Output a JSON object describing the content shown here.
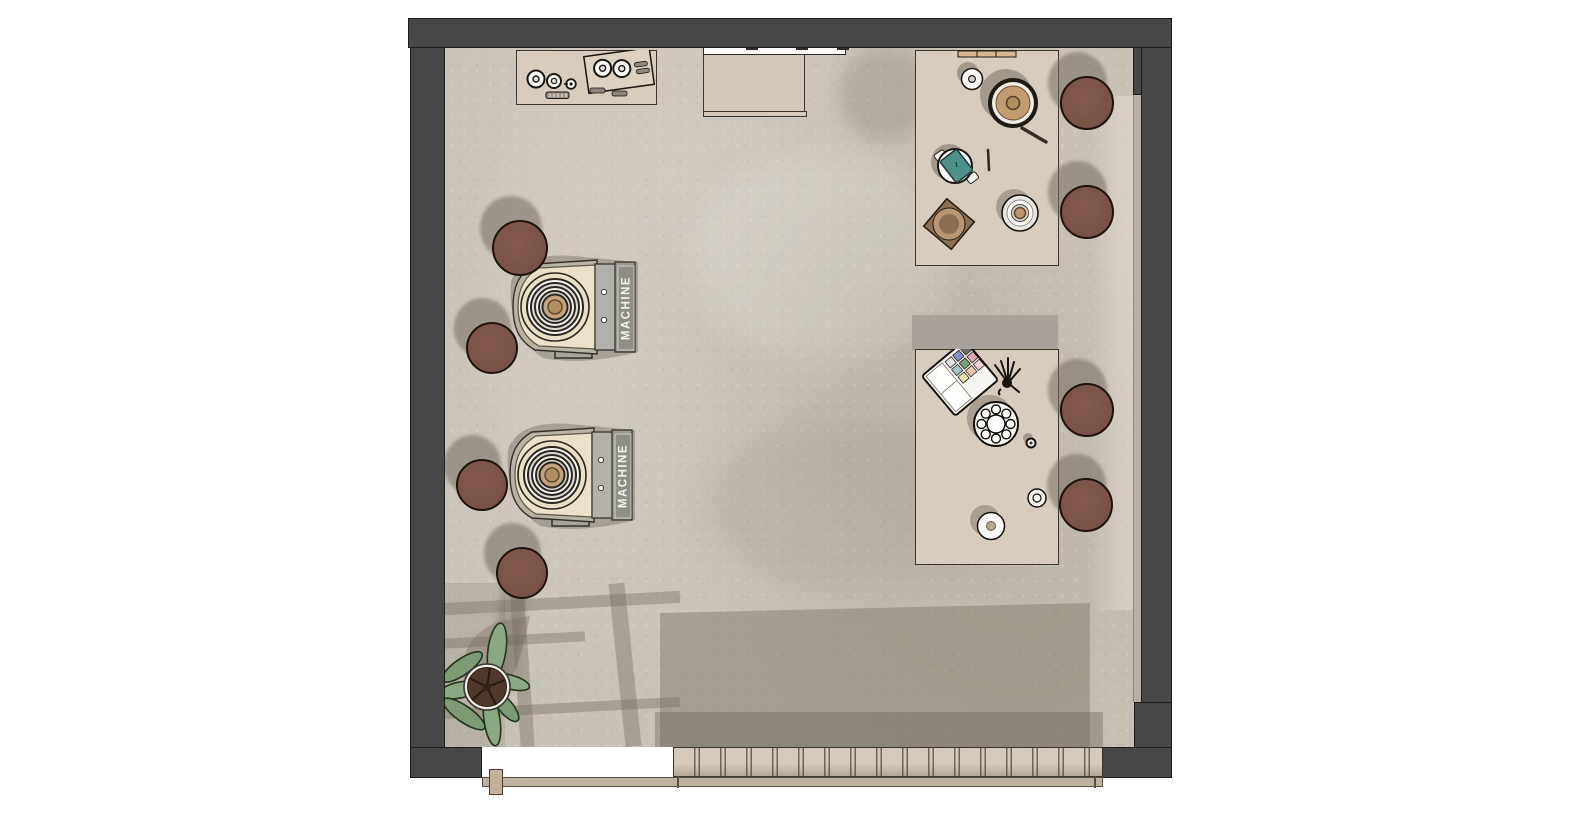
{
  "scene": {
    "title": "Coffee studio floor plan - top-down render",
    "machine_label": "MACHINE"
  },
  "colors": {
    "wall": "#474747",
    "floor": "#c8c1b6",
    "floor_shadow": "#a79e93",
    "table": "#d7ccbe",
    "bench_slats": "#d5cabb",
    "sill": "#beb1a0",
    "stool": "#7d564c",
    "machine_body_cream": "#ebe1ca",
    "machine_panel_gray": "#99998f",
    "machine_center_tan": "#c2a37b",
    "accent_teal": "#4e9188",
    "shelf_wood": "#d9b795",
    "knockbox_brown": "#8a6f52",
    "plant_leaf": "#8ba783",
    "plant_soil": "#4e382b",
    "palette_swatches": [
      "#dfdfe8",
      "#8291c4",
      "#6f6f62",
      "#abc3c8",
      "#7e9a77",
      "#e0a8b2",
      "#e8e2ac",
      "#eec4ad",
      "#efd0d8"
    ]
  },
  "inventory": [
    "top wall",
    "left wall",
    "right wall",
    "window bench",
    "window sill",
    "appliance console table",
    "wall cabinet",
    "wall shelf strip",
    "coffee bar table",
    "coffee grinder",
    "espresso cup",
    "coffee scale",
    "knock box",
    "cup with saucer",
    "bar knife",
    "stirrer",
    "beauty table",
    "makeup palette",
    "brush set",
    "rotary palette",
    "small jar",
    "small cup",
    "espresso machine 1",
    "espresso machine 2",
    "stool 1",
    "stool 2",
    "stool 3",
    "stool 4",
    "stool 5",
    "stool 6",
    "stool 7",
    "stool 8",
    "potted plant"
  ]
}
